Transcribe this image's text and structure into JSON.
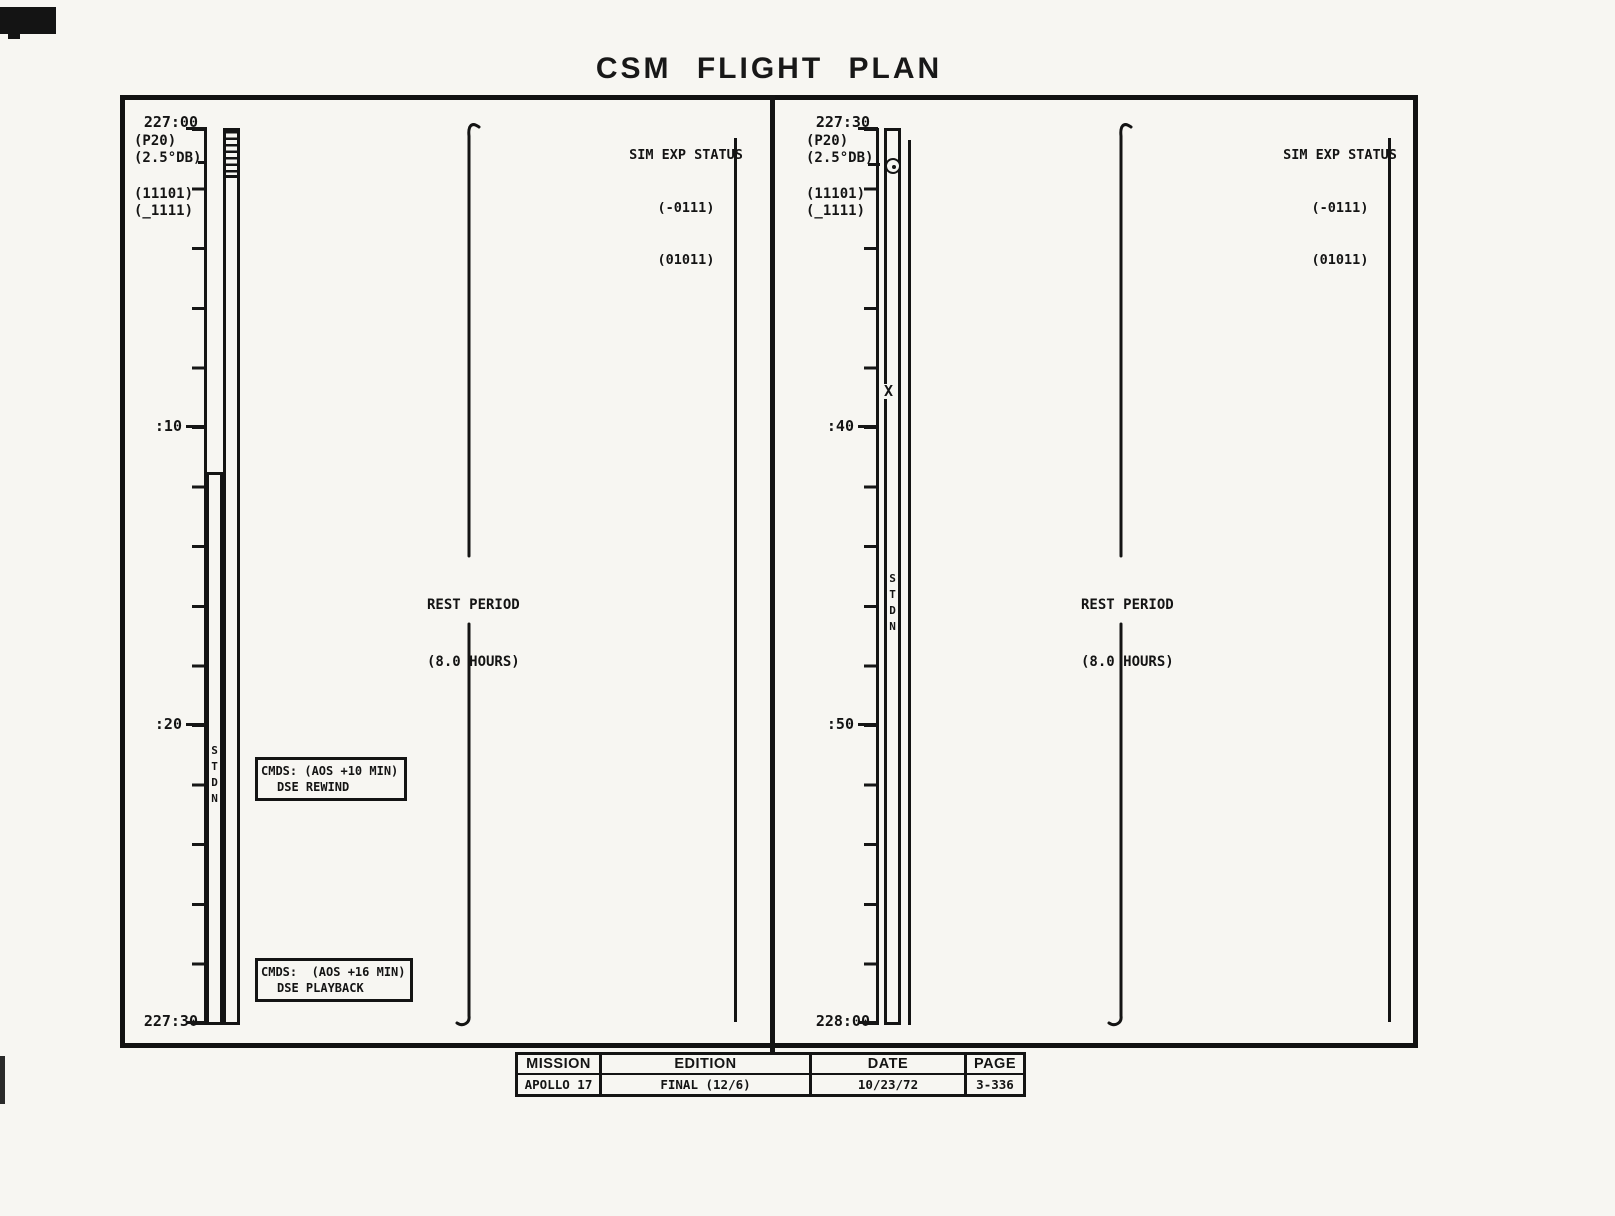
{
  "title": "CSM FLIGHT PLAN",
  "left": {
    "ticks": {
      "t0": "227:00",
      "t1": ":10",
      "t2": ":20",
      "t3": "227:30"
    },
    "p20": "(P20)",
    "db": "(2.5°DB)",
    "cfg1": "(11101)",
    "cfg2": "(_1111)",
    "stdn": [
      "S",
      "T",
      "D",
      "N"
    ],
    "sim": {
      "title": "SIM EXP STATUS",
      "l1": "(-0111)",
      "l2": "(01011)"
    },
    "rest": {
      "l1": "REST PERIOD",
      "l2": "(8.0 HOURS)"
    },
    "cmds1": {
      "l1": "CMDS: (AOS +10 MIN)",
      "l2": "DSE REWIND"
    },
    "cmds2": {
      "l1": "CMDS:  (AOS +16 MIN)",
      "l2": "DSE PLAYBACK"
    }
  },
  "right": {
    "ticks": {
      "t0": "227:30",
      "t1": ":40",
      "t2": ":50",
      "t3": "228:00"
    },
    "p20": "(P20)",
    "db": "(2.5°DB)",
    "cfg1": "(11101)",
    "cfg2": "(_1111)",
    "stdn": [
      "S",
      "T",
      "D",
      "N"
    ],
    "sim": {
      "title": "SIM EXP STATUS",
      "l1": "(-0111)",
      "l2": "(01011)"
    },
    "rest": {
      "l1": "REST PERIOD",
      "l2": "(8.0 HOURS)"
    },
    "x_marker": "X"
  },
  "footer": {
    "headers": {
      "mission": "MISSION",
      "edition": "EDITION",
      "date": "DATE",
      "page": "PAGE"
    },
    "values": {
      "mission": "APOLLO 17",
      "edition": "FINAL (12/6)",
      "date": "10/23/72",
      "page": "3-336"
    }
  },
  "colors": {
    "ink": "#141414",
    "paper": "#f7f6f2"
  }
}
